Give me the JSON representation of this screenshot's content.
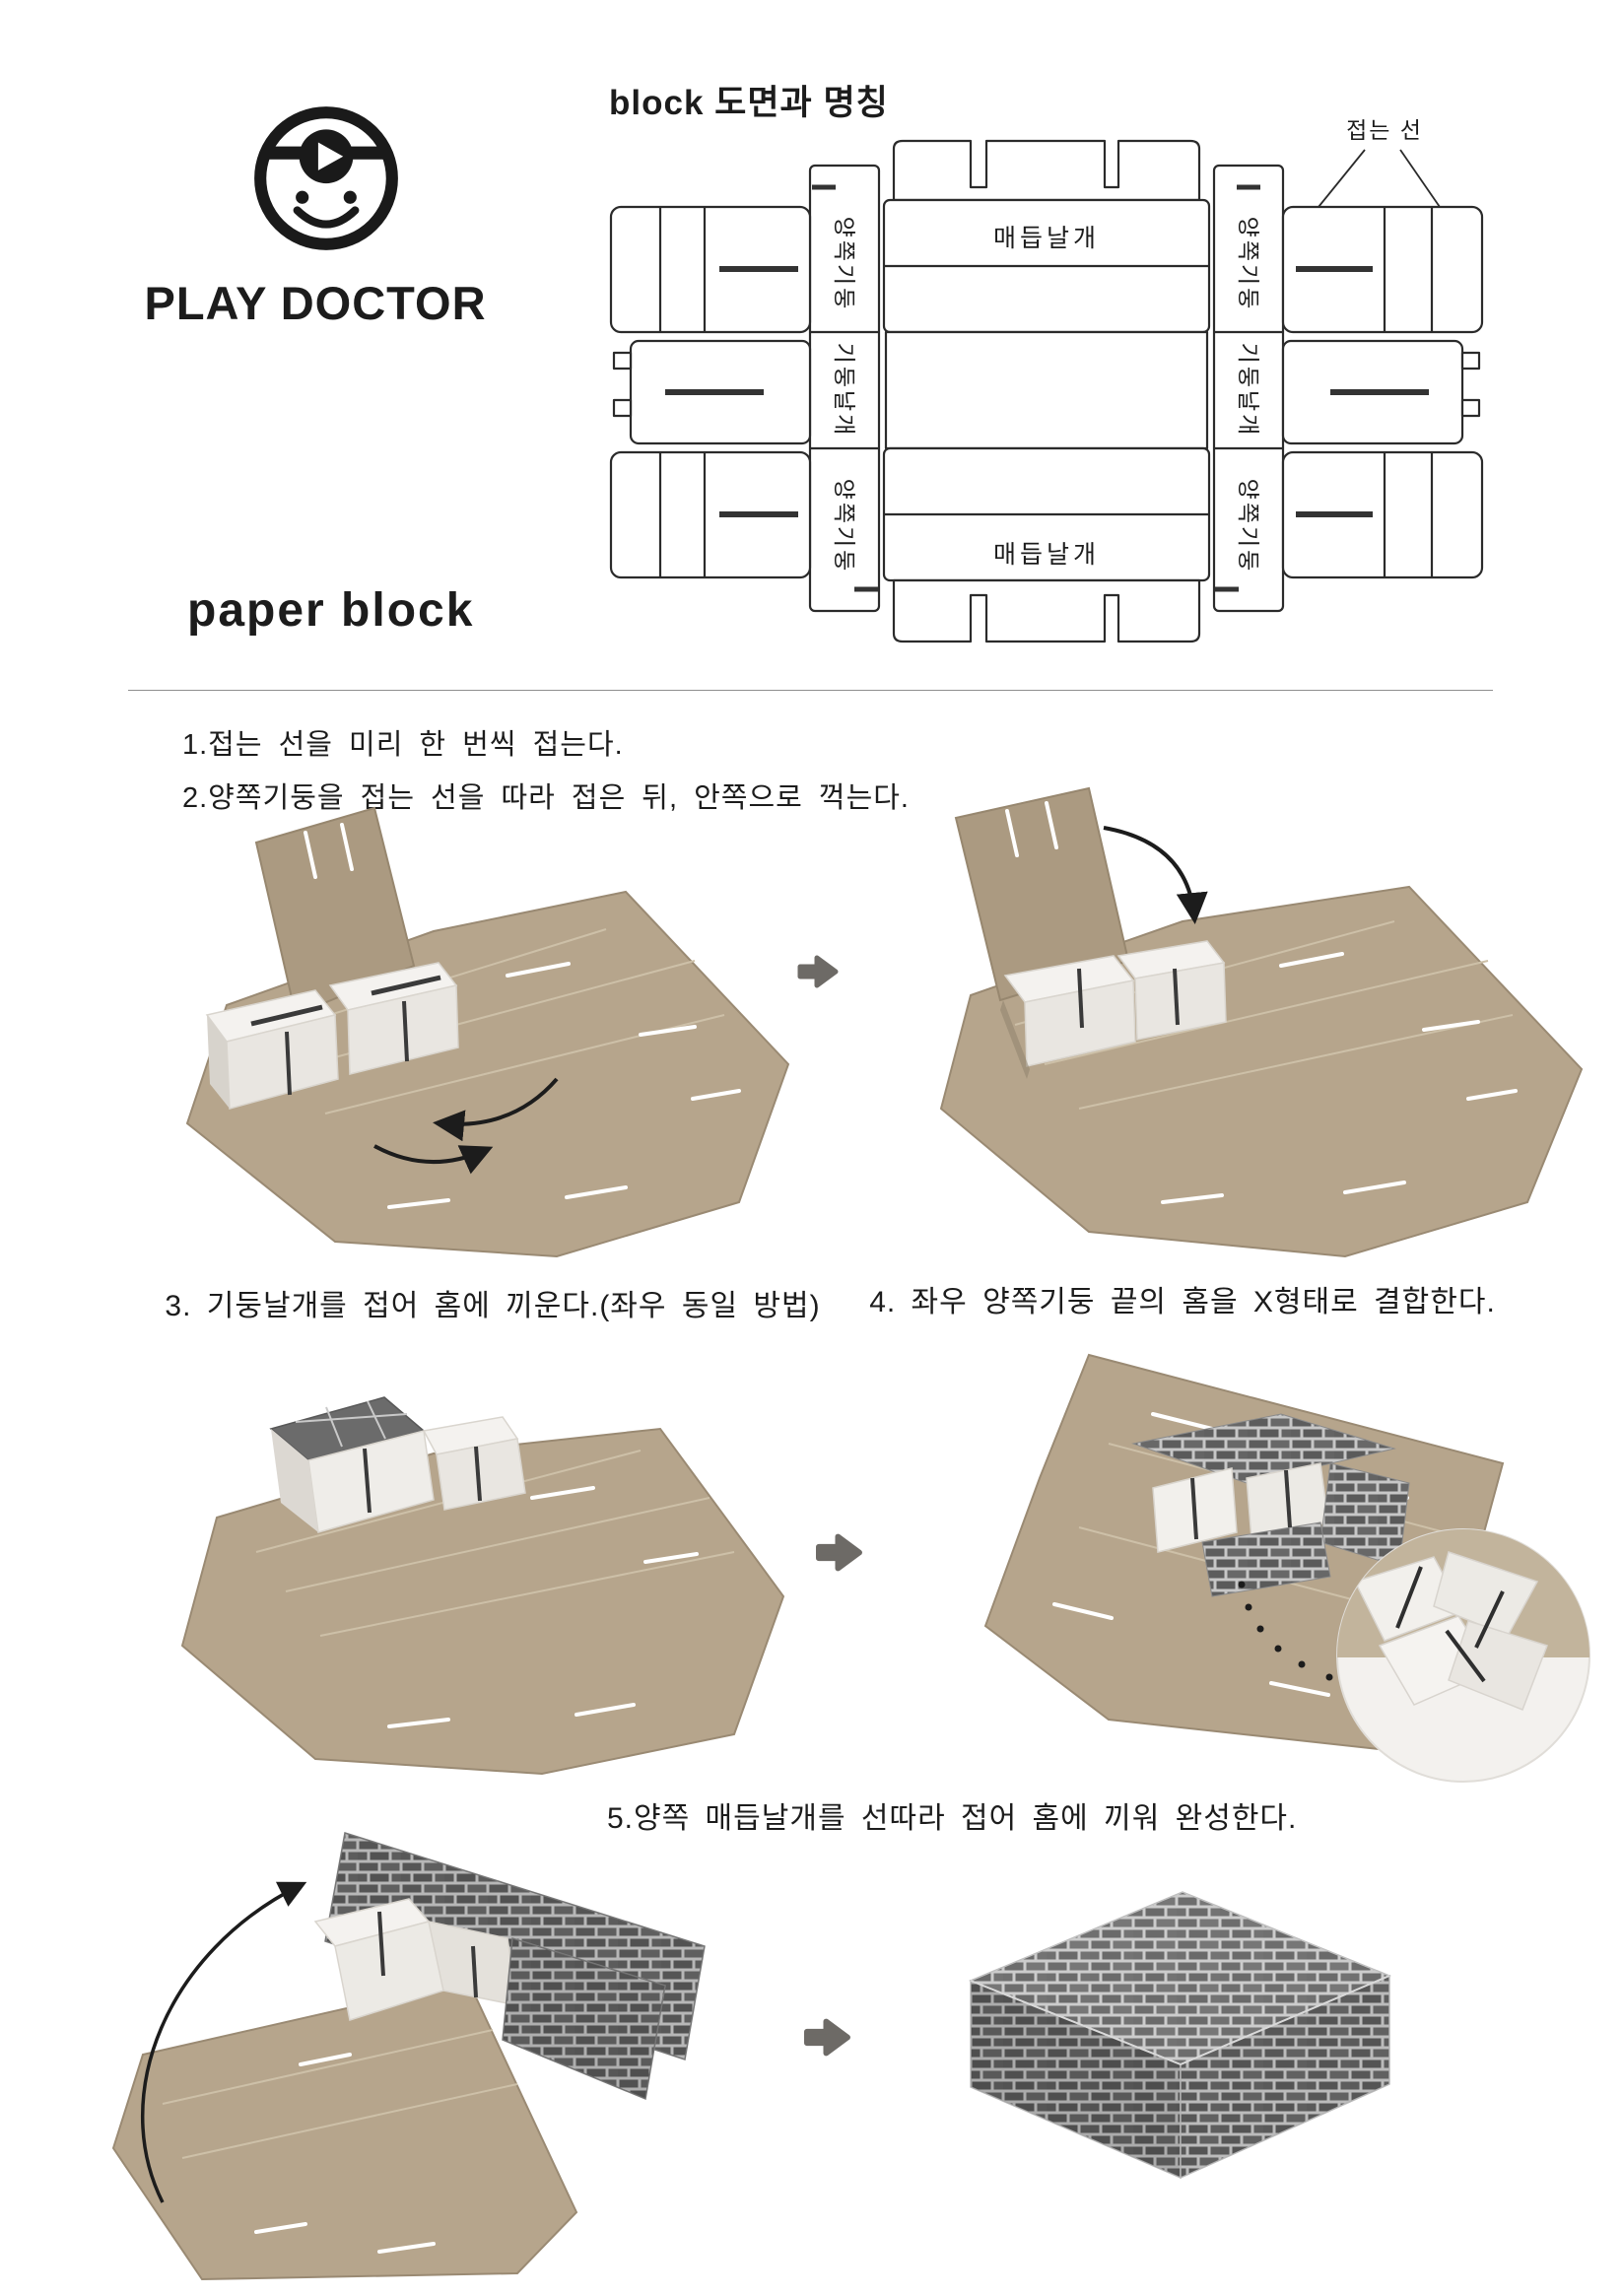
{
  "branding": {
    "logo": "play-doctor-smiley-logo",
    "name": "PLAY DOCTOR",
    "product": "paper block"
  },
  "diagram": {
    "title": "block 도면과 명칭",
    "fold_line_label": "접는 선",
    "knot_wing_label": "매듭날개",
    "side_pillar_label": "양쪽기둥",
    "pillar_wing_label": "기둥날개"
  },
  "instructions": {
    "step1": "1.접는 선을 미리 한 번씩 접는다.",
    "step2": "2.양쪽기둥을 접는 선을 따라 접은 뒤, 안쪽으로 꺽는다.",
    "step3": "3. 기둥날개를 접어 홈에 끼운다.(좌우 동일 방법)",
    "step4": "4. 좌우 양쪽기둥 끝의 홈을 X형태로 결합한다.",
    "step5": "5.양쪽 매듭날개를 선따라 접어 홈에 끼워 완성한다."
  },
  "colors": {
    "ink": "#1c1c1c",
    "kraft": "#b6a58c",
    "kraft_dark": "#a3927a",
    "kraft_score": "#cdc0a8",
    "white_block": "#f1efec",
    "brick": "#5d5d5d",
    "mortar": "#c7c7c7",
    "step_arrow": "#6d6a66"
  }
}
